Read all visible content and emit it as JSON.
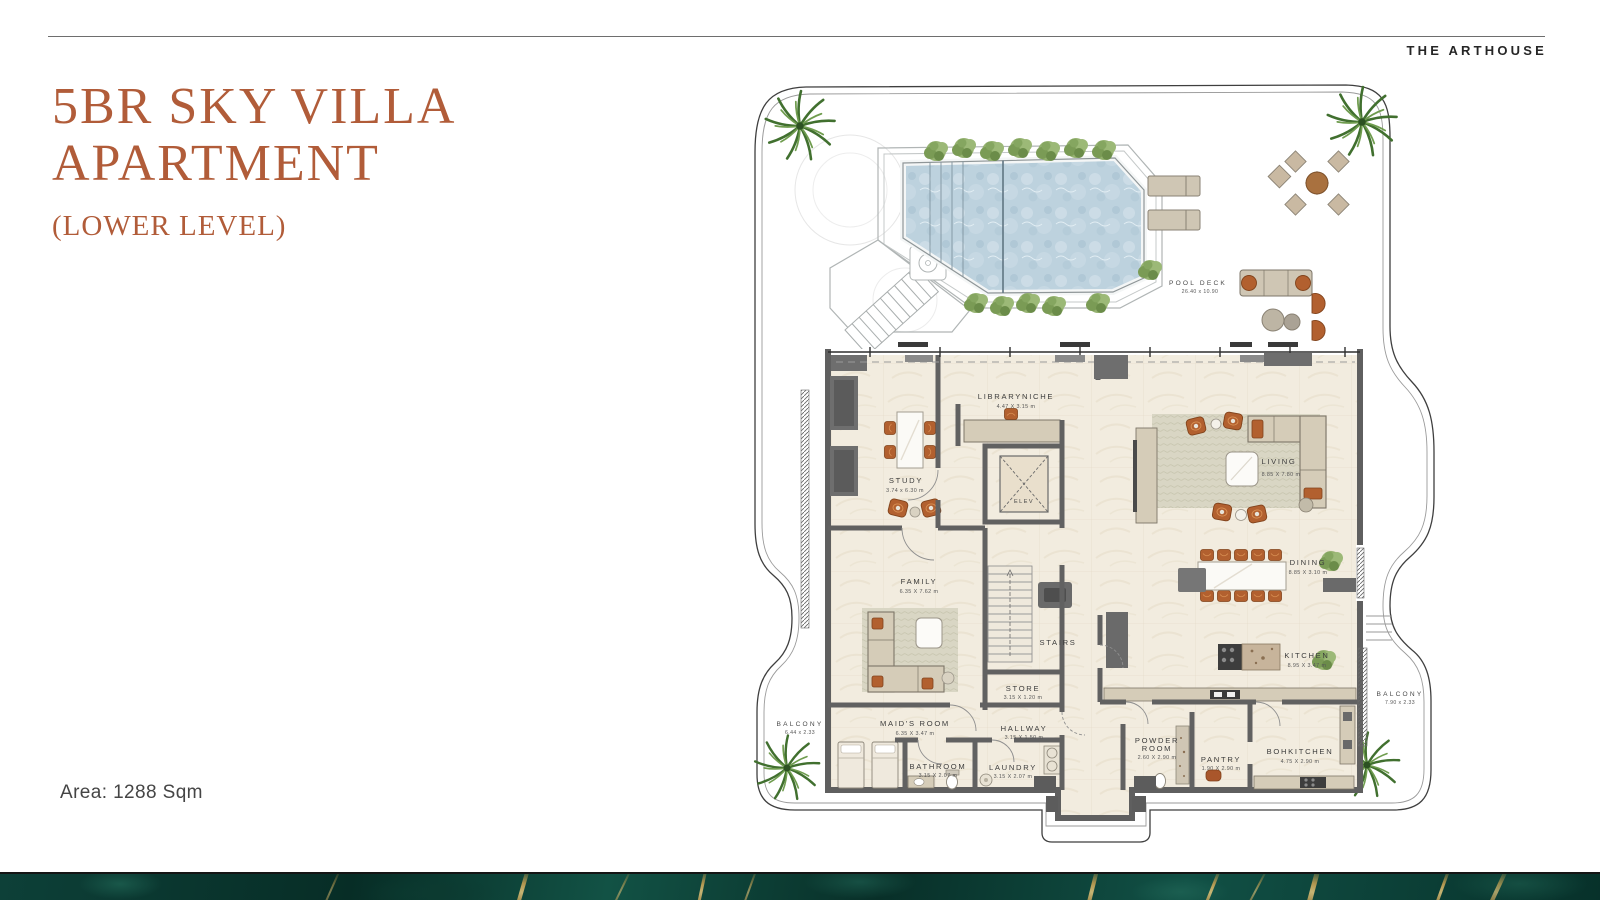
{
  "brand": "THE ARTHOUSE",
  "title": {
    "line1": "5BR SKY VILLA",
    "line2": "APARTMENT",
    "subtitle": "(LOWER LEVEL)"
  },
  "area_note": "Area: 1288 Sqm",
  "colors": {
    "accent_terracotta": "#b15c39",
    "wall_gray": "#616161",
    "floor_cream": "#f2ecdf",
    "pool_water": "#bdd2de",
    "furniture_orange": "#b2602f",
    "furniture_beige": "#d5ccb8",
    "plant_green": "#7a9b55",
    "marble_green": "#0a372f",
    "marble_gold": "#cda452"
  },
  "plan": {
    "pool_deck": {
      "name": "POOL DECK",
      "dims": "26.40 x 10.90"
    },
    "balcony_left": {
      "name": "BALCONY",
      "dims": "6.44 x 2.33"
    },
    "balcony_right": {
      "name": "BALCONY",
      "dims": "7.90 x 2.33"
    },
    "elevator": {
      "name": "ELEV"
    },
    "stairs": {
      "name": "STAIRS"
    },
    "rooms": {
      "study": {
        "name": "STUDY",
        "dims": "3.74 x 6.30 m"
      },
      "library": {
        "name": "LIBRARYNICHE",
        "dims": "4.47 X 3.15 m"
      },
      "living": {
        "name": "LIVING",
        "dims": "8.85 X 7.80 m"
      },
      "dining": {
        "name": "DINING",
        "dims": "8.85 X 3.10 m"
      },
      "kitchen": {
        "name": "KITCHEN",
        "dims": "8.95 X 3.47 m"
      },
      "family": {
        "name": "FAMILY",
        "dims": "6.35 X 7.62 m"
      },
      "store": {
        "name": "STORE",
        "dims": "3.15 X 1.20 m"
      },
      "maids": {
        "name": "MAID'S ROOM",
        "dims": "6.35 X 3.47 m"
      },
      "hallway": {
        "name": "HALLWAY",
        "dims": "3.15 X 1.50 m"
      },
      "bathroom": {
        "name": "BATHROOM",
        "dims": "3.15 X 2.07 m"
      },
      "laundry": {
        "name": "LAUNDRY",
        "dims": "3.15 X 2.07 m"
      },
      "powder": {
        "name_line1": "POWDER",
        "name_line2": "ROOM",
        "dims": "2.60 X 2.90 m"
      },
      "pantry": {
        "name": "PANTRY",
        "dims": "1.90 X 2.90 m"
      },
      "bohkitchen": {
        "name": "BOHKITCHEN",
        "dims": "4.75 X 2.90 m"
      }
    }
  }
}
